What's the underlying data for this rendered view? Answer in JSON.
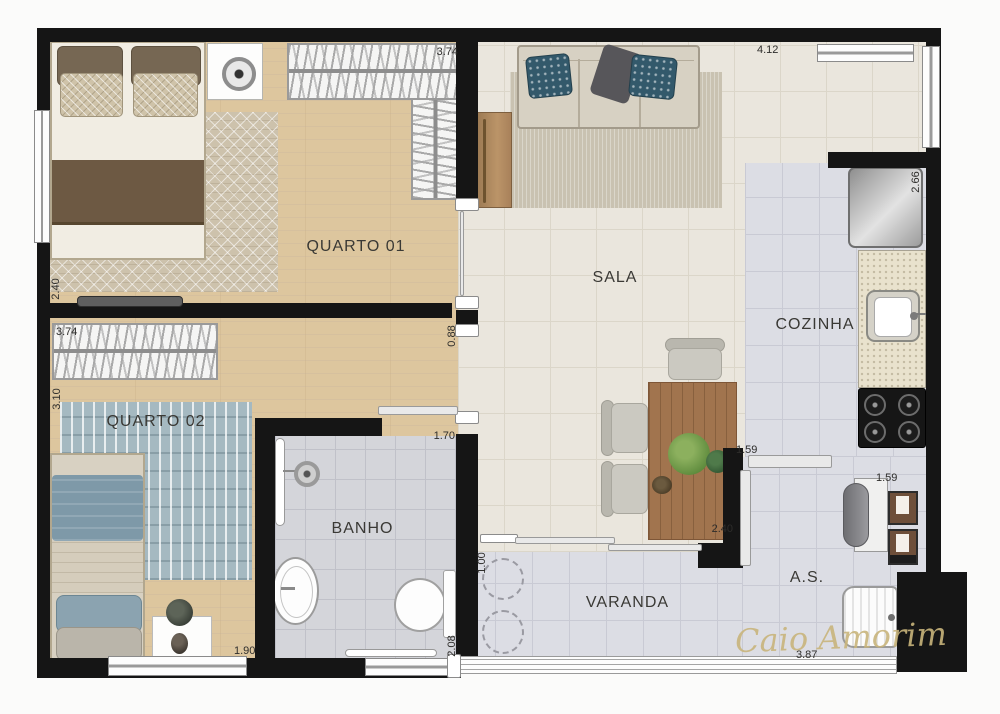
{
  "plan": {
    "type": "apartment-floor-plan",
    "watermark": "Caio Amorim",
    "rooms": [
      {
        "id": "quarto01",
        "label": "QUARTO 01"
      },
      {
        "id": "quarto02",
        "label": "QUARTO 02"
      },
      {
        "id": "sala",
        "label": "SALA"
      },
      {
        "id": "cozinha",
        "label": "COZINHA"
      },
      {
        "id": "banho",
        "label": "BANHO"
      },
      {
        "id": "varanda",
        "label": "VARANDA"
      },
      {
        "id": "as",
        "label": "A.S."
      }
    ],
    "dimensions": [
      {
        "value": "3.74",
        "where": "quarto01-top"
      },
      {
        "value": "4.12",
        "where": "sala-top"
      },
      {
        "value": "2.66",
        "where": "cozinha-right"
      },
      {
        "value": "2.40",
        "where": "quarto01-left"
      },
      {
        "value": "3.74",
        "where": "quarto02-closet"
      },
      {
        "value": "3.10",
        "where": "quarto02-left"
      },
      {
        "value": "0.88",
        "where": "hall-opening"
      },
      {
        "value": "1.70",
        "where": "banho-top"
      },
      {
        "value": "1.59",
        "where": "cozinha-bottom"
      },
      {
        "value": "1.59",
        "where": "as-top"
      },
      {
        "value": "2.40",
        "where": "dining-table"
      },
      {
        "value": "1.00",
        "where": "varanda-left"
      },
      {
        "value": "2.08",
        "where": "banho-bottom-right"
      },
      {
        "value": "1.90",
        "where": "quarto02-bottom"
      },
      {
        "value": "3.87",
        "where": "varanda-bottom"
      }
    ],
    "colors": {
      "wall": "#151515",
      "wood_floor": "#ddc69e",
      "sala_tile": "#eae6dd",
      "service_tile": "#dcdde4",
      "bath_tile": "#d4d5da",
      "table_wood": "#a1744e",
      "pillow_teal": "#33596b",
      "watermark_gold": "#c9b57c"
    }
  }
}
